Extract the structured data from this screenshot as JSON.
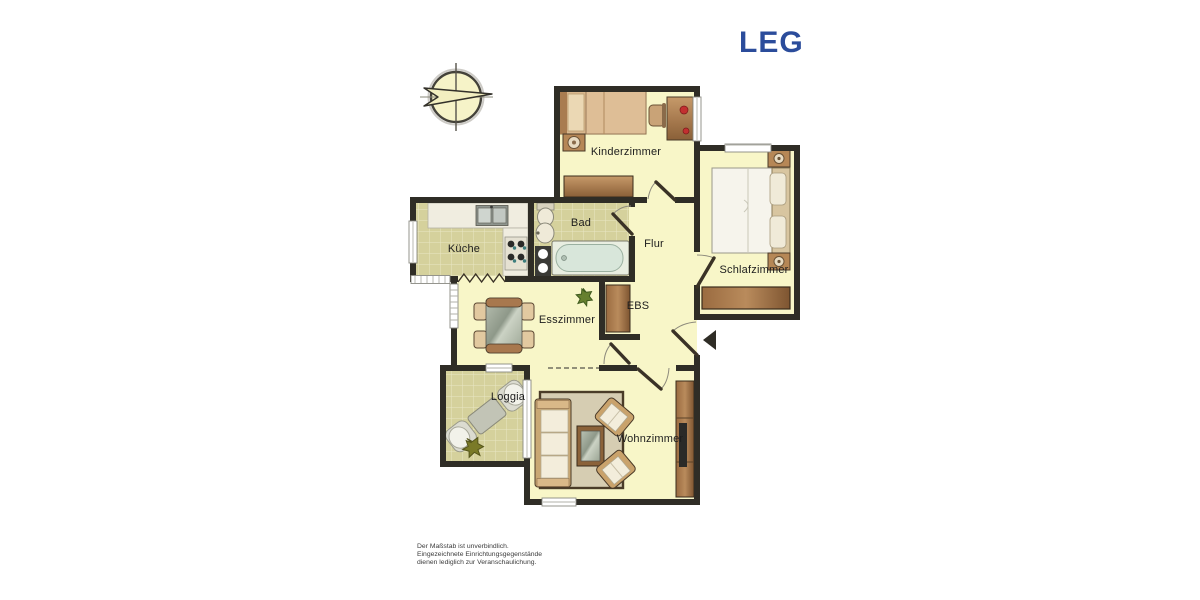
{
  "logo": {
    "text": "LEG",
    "color": "#2B4C9B"
  },
  "rooms": [
    {
      "id": "kinderzimmer",
      "label": "Kinderzimmer"
    },
    {
      "id": "schlafzimmer",
      "label": "Schlafzimmer"
    },
    {
      "id": "bad",
      "label": "Bad"
    },
    {
      "id": "flur",
      "label": "Flur"
    },
    {
      "id": "kueche",
      "label": "Küche"
    },
    {
      "id": "ebs",
      "label": "EBS"
    },
    {
      "id": "esszimmer",
      "label": "Esszimmer"
    },
    {
      "id": "loggia",
      "label": "Loggia"
    },
    {
      "id": "wohnzimmer",
      "label": "Wohnzimmer"
    }
  ],
  "disclaimer": {
    "line1": "Der Maßstab ist unverbindlich.",
    "line2": "Eingezeichnete Einrichtungsgegenstände",
    "line3": "dienen lediglich zur Veranschaulichung."
  },
  "icons": [
    "compass-rose-icon",
    "entrance-arrow-icon",
    "radiator-icon"
  ],
  "colors": {
    "wall": "#2F2D26",
    "room_floor": "#F8F6C8",
    "tile_floor": "#D5D19C",
    "tile_line": "#E9E6C4",
    "logo_blue": "#2B4C9B",
    "furniture_brown": "#A9794E",
    "furniture_tan": "#D9B88E",
    "cushion_cream": "#F3EDDB",
    "tub_water": "#D8E6DA",
    "rug": "#D6CDB2"
  }
}
